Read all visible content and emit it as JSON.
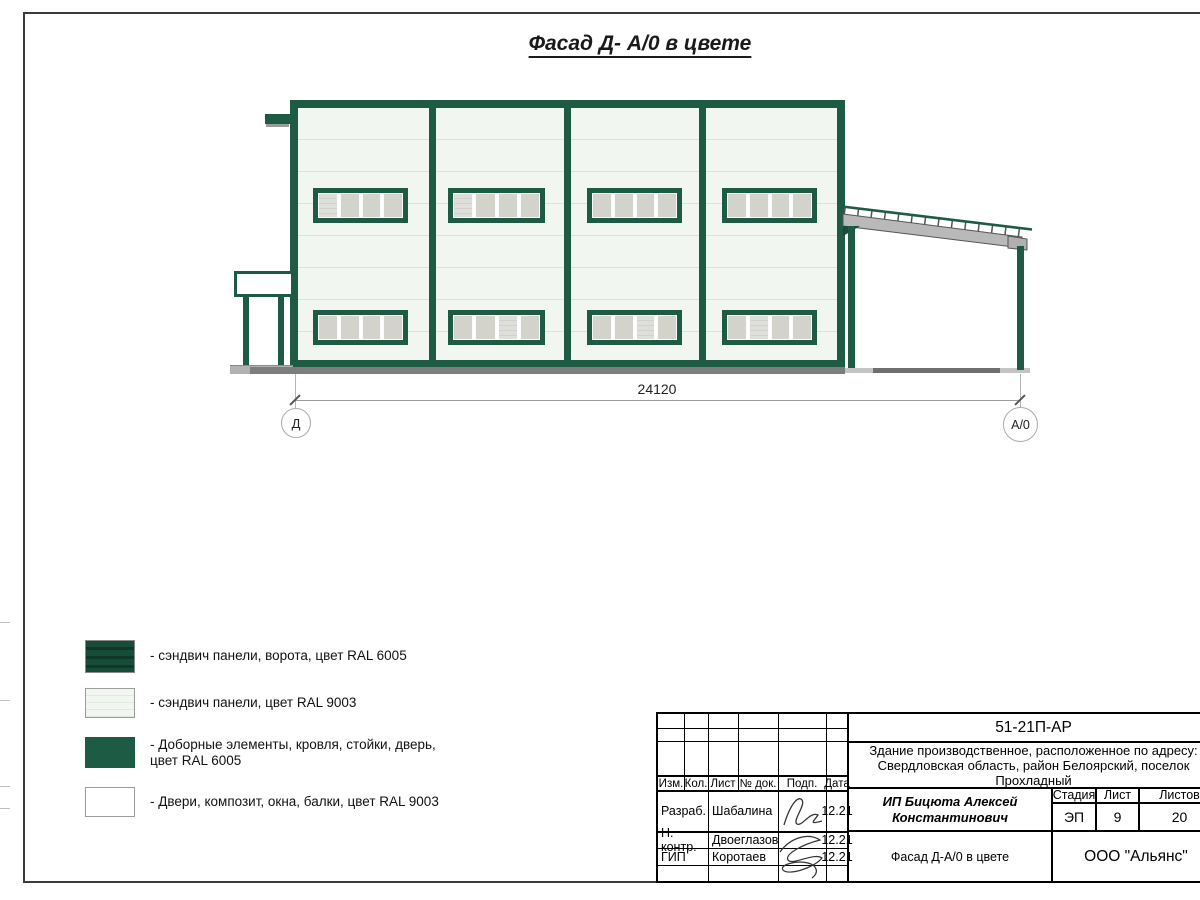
{
  "page": {
    "title": "Фасад Д- А/0 в цвете"
  },
  "drawing": {
    "dimension_label": "24120",
    "axis_left": "Д",
    "axis_right": "А/0",
    "colors": {
      "ral6005_green": "#1e5b45",
      "ral6005_gate_green": "#174c38",
      "ral9003_panel": "#f1f6f0",
      "window_pane_gray": "#d3d3cb",
      "roof_beam_gray": "#b9b9b9",
      "ground_gray": "#7d7d7d"
    }
  },
  "legend": {
    "items": [
      {
        "swatch": "gate-sandwich-panels",
        "label": "- сэндвич панели, ворота, цвет RAL 6005"
      },
      {
        "swatch": "light-sandwich-panels",
        "label": "- сэндвич панели, цвет RAL 9003"
      },
      {
        "swatch": "solid-green-elements",
        "label": "- Доборные элементы, кровля, стойки, дверь, цвет RAL 6005"
      },
      {
        "swatch": "white-elements",
        "label": "- Двери, композит, окна, балки, цвет RAL 9003"
      }
    ]
  },
  "tb": {
    "doc_number": "51-21П-АР",
    "object": "Здание производственное, расположенное по адресу: Свердловская область, район Белоярский, поселок Прохладный",
    "client": "ИП Бицюта Алексей Константинович",
    "sheet_title": "Фасад Д-А/0 в цвете",
    "company": "ООО \"Альянс\"",
    "cols": {
      "izm": "Изм.",
      "kol": "Кол.",
      "list": "Лист",
      "doc": "№ док.",
      "podp": "Подп.",
      "data": "Дата"
    },
    "stage": {
      "h_stage": "Стадия",
      "h_sheet": "Лист",
      "h_sheets": "Листов",
      "v_stage": "ЭП",
      "v_sheet": "9",
      "v_sheets": "20"
    },
    "rows": [
      {
        "role": "Разраб.",
        "name": "Шабалина",
        "date": "12.21"
      },
      {
        "role": "Н. контр.",
        "name": "Двоеглазов",
        "date": "12.21"
      },
      {
        "role": "ГИП",
        "name": "Коротаев",
        "date": "12.21"
      }
    ]
  }
}
